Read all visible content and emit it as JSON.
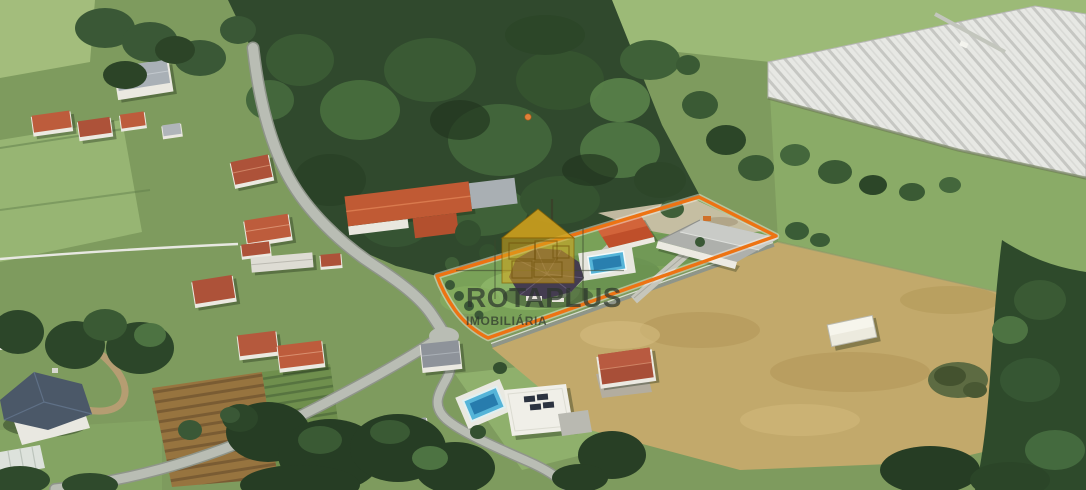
{
  "image": {
    "kind": "aerial-3d-satellite-photo",
    "subject": "rural land parcel for sale outlined in orange with villa, warehouse and swimming pool"
  },
  "watermark": {
    "brand": "ROTAPLUS",
    "tagline": "IMOBILIÁRIA",
    "icon": "house-blueprint-icon"
  },
  "boundary": {
    "label": "highlighted-property-parcel",
    "color": "#ED7313"
  },
  "marker": {
    "label": "small-orange-dot-in-forest",
    "color": "#E0813A"
  },
  "colors": {
    "boundary_orange": "#ED7313",
    "logo_gold": "#D7A51C",
    "logo_text": "rgba(44,54,44,0.72)",
    "pool_water": "#55B4D8",
    "pool_water_deep": "#2276A8",
    "forest_green": "#30492D",
    "field_green": "#7E9B5E",
    "dry_field_tan": "#C2A96B",
    "greenhouse_white": "#E7E8E4",
    "roof_terracotta": "#B5593D",
    "road_gray": "#B9BDB4"
  }
}
